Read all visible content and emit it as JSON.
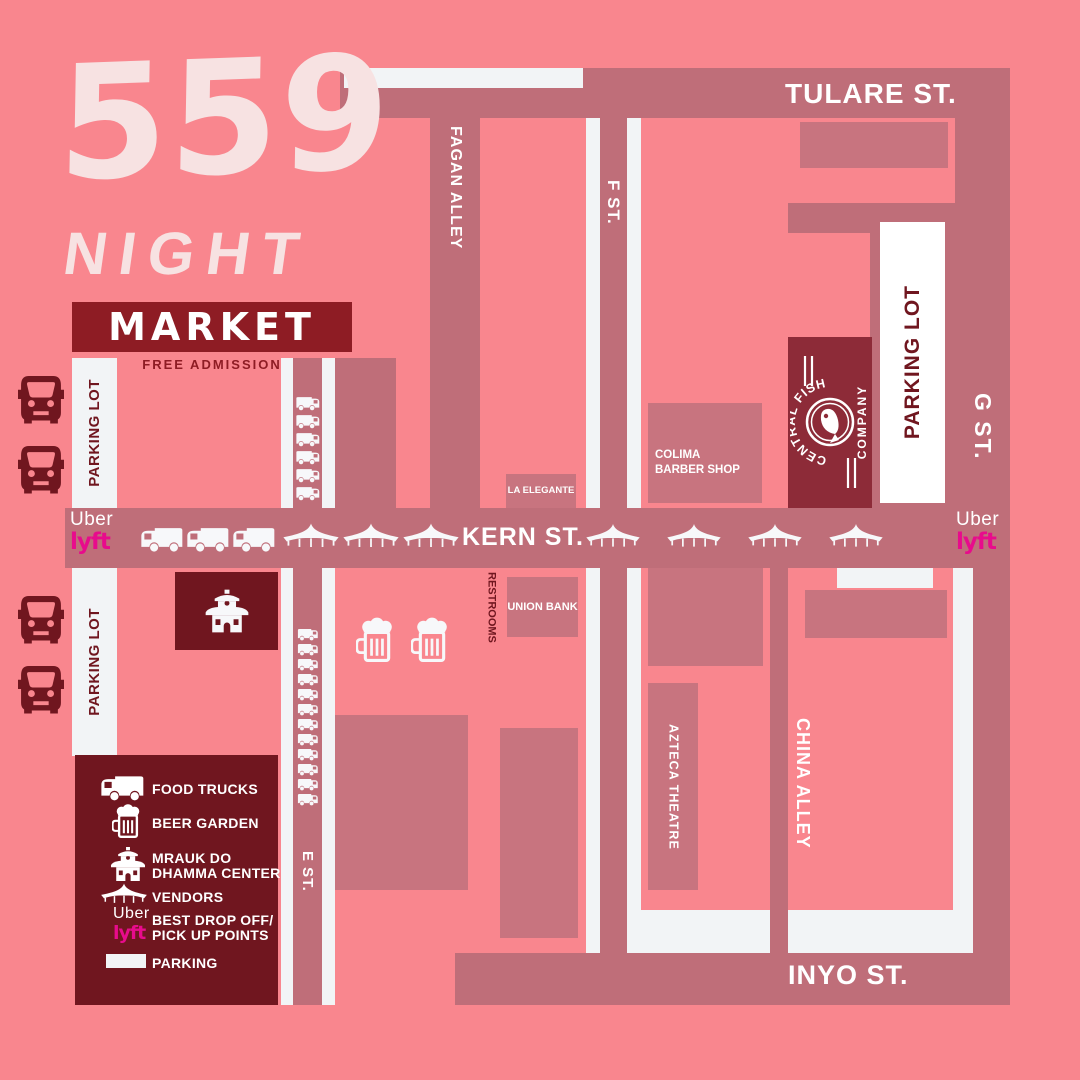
{
  "colors": {
    "bg": "#F9868E",
    "street": "#BF6E79",
    "building": "#C8747F",
    "strip": "#F2F4F6",
    "white": "#FFFFFF",
    "maroon_dark": "#70161F",
    "maroon_market": "#8E1C24",
    "maroon_fish": "#8D2B38",
    "title": "#F7E2E2",
    "lyft_pink": "#E80B8C"
  },
  "title": {
    "number": "559",
    "night": "NIGHT",
    "market": "MARKET",
    "free_admission": "FREE ADMISSION"
  },
  "streets": {
    "tulare": "TULARE ST.",
    "kern": "KERN ST.",
    "inyo": "INYO ST.",
    "g": "G ST.",
    "f": "F ST.",
    "e": "E ST.",
    "fagan": "FAGAN ALLEY",
    "china": "CHINA ALLEY"
  },
  "places": {
    "parking_lot": "PARKING LOT",
    "la_elegante": "LA ELEGANTE",
    "colima_line1": "COLIMA",
    "colima_line2": "BARBER SHOP",
    "union_bank": "UNION BANK",
    "azteca": "AZTECA THEATRE",
    "restrooms": "RESTROOMS",
    "central_fish": {
      "arc": "CENTRAL FISH",
      "company": "COMPANY"
    }
  },
  "rideshare": {
    "uber": "Uber",
    "lyft": "lyft"
  },
  "legend": {
    "items": [
      {
        "icon": "food-truck",
        "label": "FOOD TRUCKS",
        "label2": ""
      },
      {
        "icon": "beer-mug",
        "label": "BEER GARDEN",
        "label2": ""
      },
      {
        "icon": "pagoda",
        "label": "MRAUK DO",
        "label2": "DHAMMA CENTER"
      },
      {
        "icon": "tent",
        "label": "VENDORS",
        "label2": ""
      },
      {
        "icon": "rideshare",
        "label": "BEST DROP OFF/",
        "label2": "PICK UP POINTS"
      },
      {
        "icon": "parking-swatch",
        "label": "PARKING",
        "label2": ""
      }
    ]
  },
  "counts": {
    "kern_food_trucks": 3,
    "kern_tents_west": 3,
    "kern_tents_east": 4,
    "e_street_trucks_north": 6,
    "e_street_trucks_south": 12,
    "cars_north": 2,
    "cars_south": 2,
    "beer_mugs": 2
  }
}
